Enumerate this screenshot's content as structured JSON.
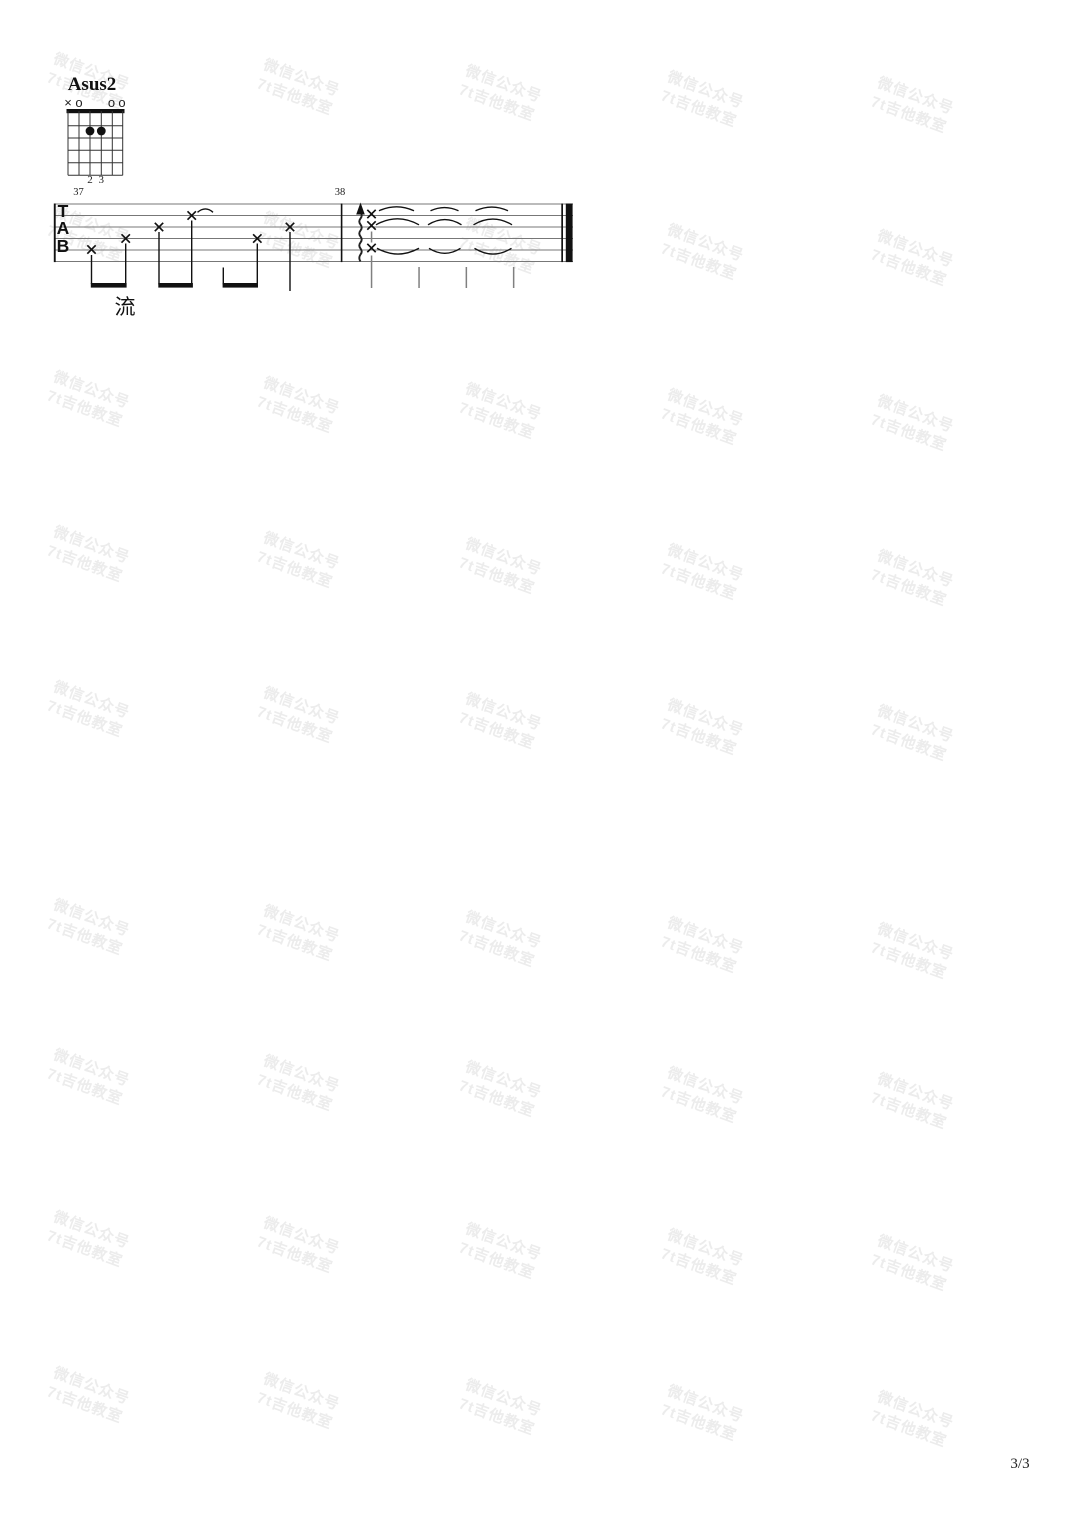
{
  "watermark": {
    "line1": "微信公众号",
    "line2": "7t吉他教室",
    "color": "#ececec"
  },
  "chord_diagram": {
    "name": "Asus2",
    "string_markers": [
      {
        "string": 6,
        "symbol": "×"
      },
      {
        "string": 5,
        "symbol": "o"
      },
      {
        "string": 2,
        "symbol": "o"
      },
      {
        "string": 1,
        "symbol": "o"
      }
    ],
    "dots": [
      {
        "string": 4,
        "fret": 2
      },
      {
        "string": 3,
        "fret": 2
      }
    ],
    "fingers": [
      "2",
      "3"
    ]
  },
  "tab": {
    "clef_letters": [
      "T",
      "A",
      "B"
    ],
    "measures": [
      {
        "number": "37",
        "notes": [
          {
            "string": 5,
            "head": "x"
          },
          {
            "string": 4,
            "head": "x"
          },
          {
            "string": 3,
            "head": "x"
          },
          {
            "string": 2,
            "head": "x",
            "tie": true
          },
          {
            "string": 4,
            "head": "x"
          },
          {
            "string": 3,
            "head": "x"
          }
        ]
      },
      {
        "number": "38",
        "strum_chord": {
          "strings": [
            2,
            3,
            5
          ],
          "head": "x",
          "direction": "up"
        },
        "let_ring_beats": 3
      }
    ],
    "lyric": "流"
  },
  "footer": {
    "page_number": "3/3"
  }
}
